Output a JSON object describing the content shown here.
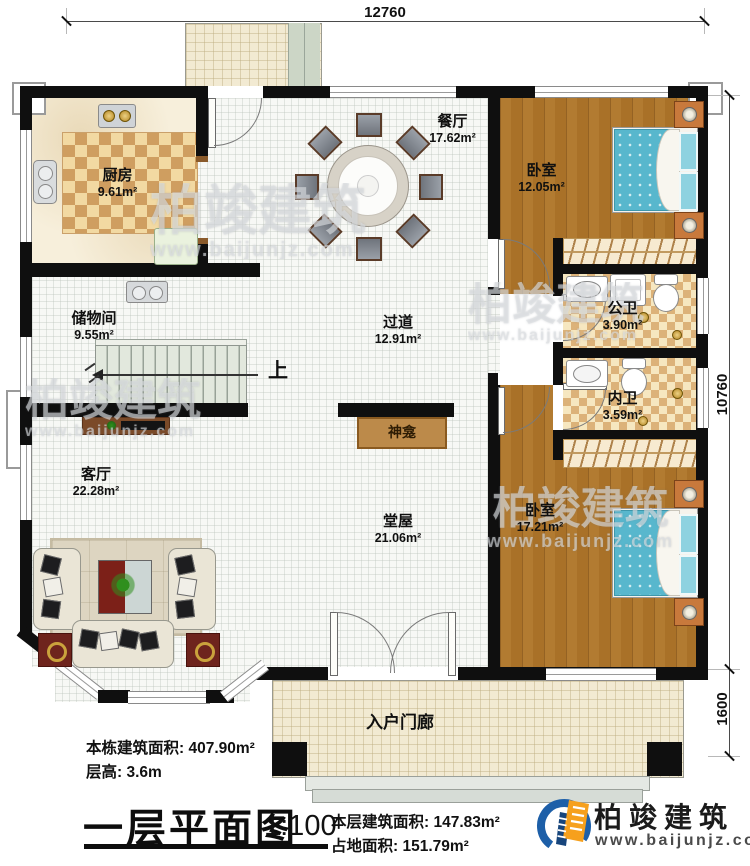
{
  "dimensions": {
    "width_top": "12760",
    "height_right": "10760",
    "porch_right": "1600"
  },
  "rooms": {
    "kitchen": {
      "name": "厨房",
      "area": "9.61m²"
    },
    "dining": {
      "name": "餐厅",
      "area": "17.62m²"
    },
    "bedroom_top": {
      "name": "卧室",
      "area": "12.05m²"
    },
    "storage": {
      "name": "储物间",
      "area": "9.55m²"
    },
    "hallway": {
      "name": "过道",
      "area": "12.91m²"
    },
    "public_bathroom": {
      "name": "公卫",
      "area": "3.90m²"
    },
    "private_bathroom": {
      "name": "内卫",
      "area": "3.59m²"
    },
    "living_room": {
      "name": "客厅",
      "area": "22.28m²"
    },
    "main_hall": {
      "name": "堂屋",
      "area": "21.06m²"
    },
    "bedroom_bottom": {
      "name": "卧室",
      "area": "17.21m²"
    },
    "entry_porch": {
      "name": "入户门廊"
    },
    "shrine": {
      "name": "神龛"
    },
    "stairs_up_label": "上"
  },
  "notes": {
    "building_area": "本栋建筑面积: 407.90m²",
    "floor_height": "层高: 3.6m"
  },
  "title_block": {
    "title": "一层平面图",
    "scale": "1:100",
    "floor_area": "本层建筑面积: 147.83m²",
    "footprint_area": "占地面积: 151.79m²"
  },
  "brand": {
    "name": "柏竣建筑",
    "website": "www.baijunjz.com"
  },
  "watermark": {
    "name": "柏竣建筑",
    "website": "www.baijunjz.com"
  },
  "colors": {
    "wall": "#0f0f0f",
    "wood": "#ab742d",
    "mattress": "#58b7cd",
    "brand_blue": "#1d5fa8",
    "brand_orange": "#f6a01d"
  }
}
